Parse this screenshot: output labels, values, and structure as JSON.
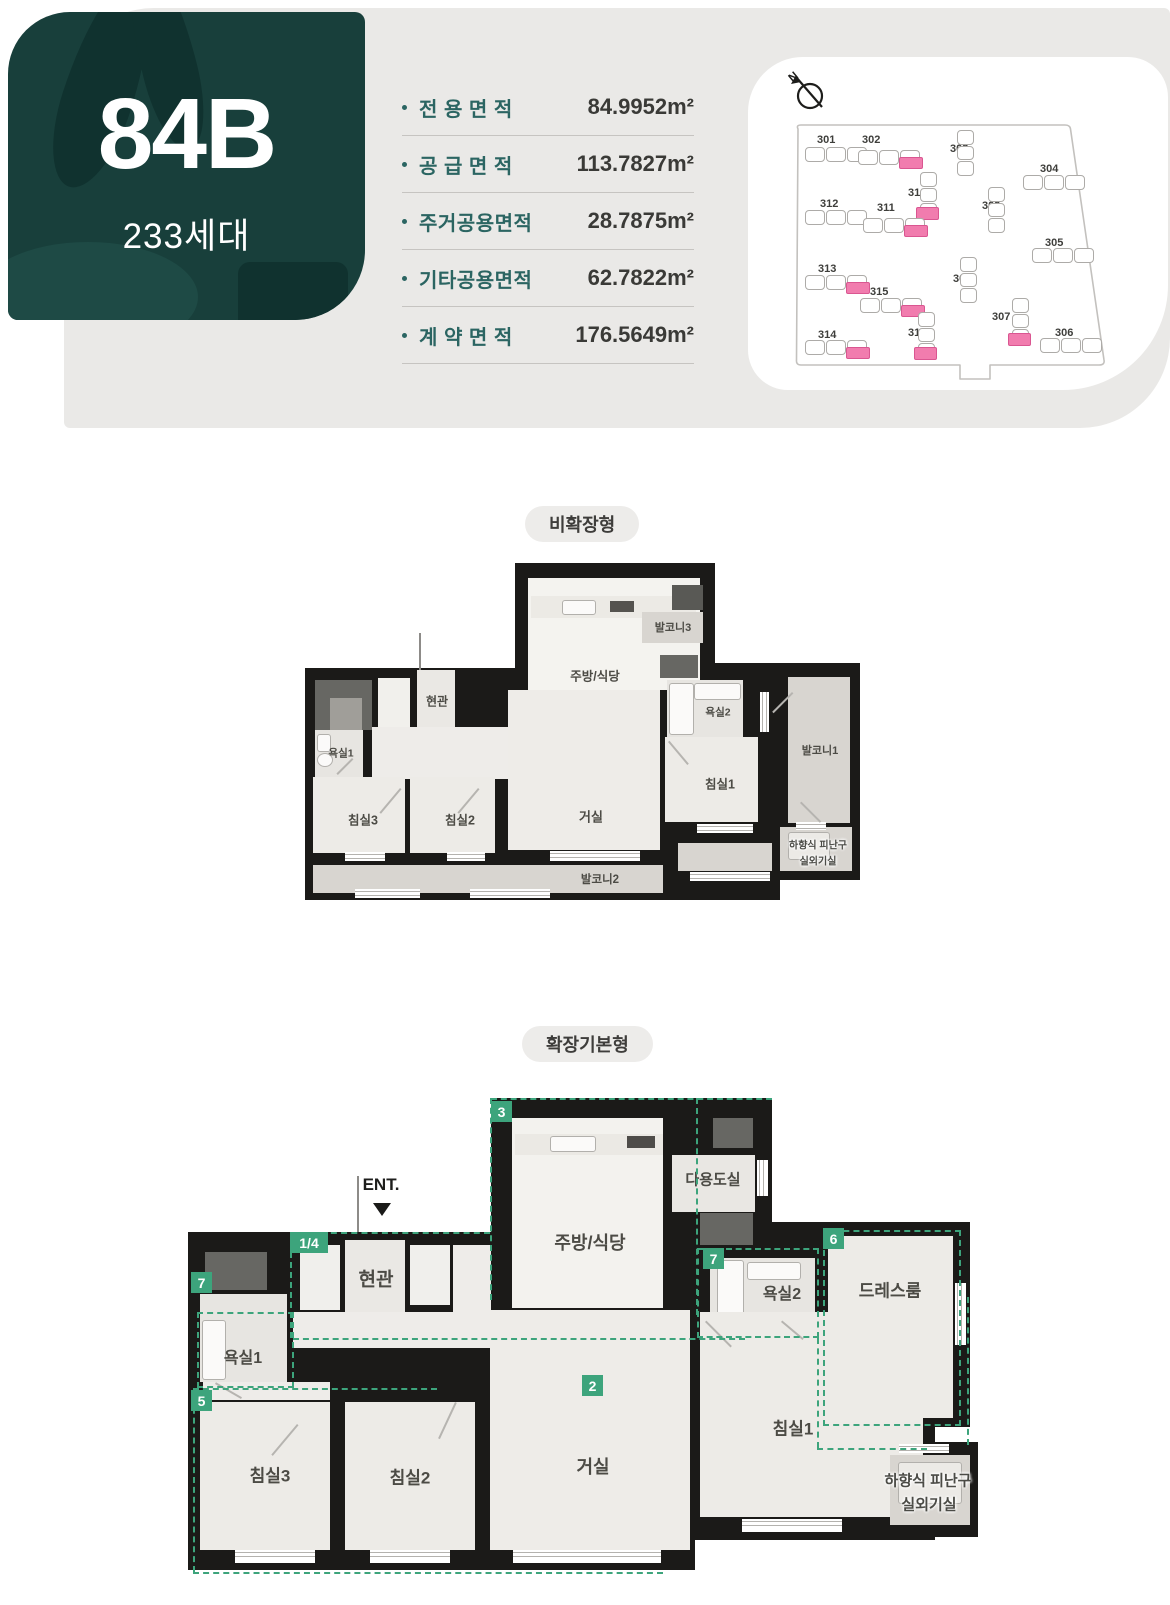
{
  "hero": {
    "unit_code": "84B",
    "households": "233세대",
    "bg_color": "#183f3b"
  },
  "areas": {
    "rows": [
      {
        "label": "전 용 면 적",
        "value": "84.9952m²"
      },
      {
        "label": "공 급 면 적",
        "value": "113.7827m²"
      },
      {
        "label": "주거공용면적",
        "value": "28.7875m²"
      },
      {
        "label": "기타공용면적",
        "value": "62.7822m²"
      },
      {
        "label": "계 약 면 적",
        "value": "176.5649m²"
      }
    ]
  },
  "site_plan": {
    "north_label": "N",
    "highlight_color": "#f17cae",
    "buildings": [
      {
        "no": "301",
        "lx": 69,
        "ly": 77,
        "fx": 57,
        "fy": 90,
        "dir": "h",
        "hl": false
      },
      {
        "no": "302",
        "lx": 114,
        "ly": 77,
        "fx": 110,
        "fy": 93,
        "dir": "h",
        "hl": true
      },
      {
        "no": "303",
        "lx": 202,
        "ly": 86,
        "fx": 209,
        "fy": 73,
        "dir": "v",
        "hl": false
      },
      {
        "no": "304",
        "lx": 292,
        "ly": 106,
        "fx": 275,
        "fy": 118,
        "dir": "h",
        "hl": false
      },
      {
        "no": "310",
        "lx": 160,
        "ly": 130,
        "fx": 172,
        "fy": 115,
        "dir": "v",
        "hl": true
      },
      {
        "no": "312",
        "lx": 72,
        "ly": 141,
        "fx": 57,
        "fy": 153,
        "dir": "h",
        "hl": false
      },
      {
        "no": "311",
        "lx": 129,
        "ly": 145,
        "fx": 115,
        "fy": 161,
        "dir": "h",
        "hl": true
      },
      {
        "no": "309",
        "lx": 234,
        "ly": 143,
        "fx": 240,
        "fy": 130,
        "dir": "v",
        "hl": false
      },
      {
        "no": "305",
        "lx": 297,
        "ly": 180,
        "fx": 284,
        "fy": 191,
        "dir": "h",
        "hl": false
      },
      {
        "no": "313",
        "lx": 70,
        "ly": 206,
        "fx": 57,
        "fy": 218,
        "dir": "h",
        "hl": true
      },
      {
        "no": "315",
        "lx": 122,
        "ly": 229,
        "fx": 112,
        "fy": 241,
        "dir": "h",
        "hl": true
      },
      {
        "no": "308",
        "lx": 205,
        "ly": 216,
        "fx": 212,
        "fy": 200,
        "dir": "v",
        "hl": false
      },
      {
        "no": "307",
        "lx": 244,
        "ly": 254,
        "fx": 264,
        "fy": 241,
        "dir": "v",
        "hl": true
      },
      {
        "no": "314",
        "lx": 70,
        "ly": 272,
        "fx": 57,
        "fy": 283,
        "dir": "h",
        "hl": true
      },
      {
        "no": "316",
        "lx": 160,
        "ly": 270,
        "fx": 170,
        "fy": 255,
        "dir": "v",
        "hl": true
      },
      {
        "no": "306",
        "lx": 307,
        "ly": 270,
        "fx": 292,
        "fy": 281,
        "dir": "h",
        "hl": false
      }
    ]
  },
  "plan1": {
    "tab": "비확장형",
    "rooms": {
      "kitchen": "주방/식당",
      "balcony3": "발코니3",
      "entrance": "현관",
      "bath1": "욕실1",
      "bed3": "침실3",
      "bed2": "침실2",
      "living": "거실",
      "bath2": "욕실2",
      "bed1": "침실1",
      "balcony1": "발코니1",
      "balcony2": "발코니2"
    },
    "evac1": "하향식 피난구",
    "evac2": "실외기실"
  },
  "plan2": {
    "tab": "확장기본형",
    "ent_label": "ENT.",
    "rooms": {
      "kitchen": "주방/식당",
      "utility": "다용도실",
      "entrance": "현관",
      "bath1": "욕실1",
      "bed3": "침실3",
      "bed2": "침실2",
      "living": "거실",
      "bath2": "욕실2",
      "dress": "드레스룸",
      "bed1": "침실1"
    },
    "evac1": "하향식 피난구",
    "evac2": "실외기실",
    "badges": {
      "kitchen": "3",
      "entry": "1/4",
      "bath1": "7",
      "bath2": "7",
      "dress": "6",
      "bedrooms": "5",
      "living": "2"
    }
  },
  "colors": {
    "accent_teal": "#2b6562",
    "hero_bg": "#183f3b",
    "zone_green": "#3da47c",
    "highlight_pink": "#f17cae"
  }
}
